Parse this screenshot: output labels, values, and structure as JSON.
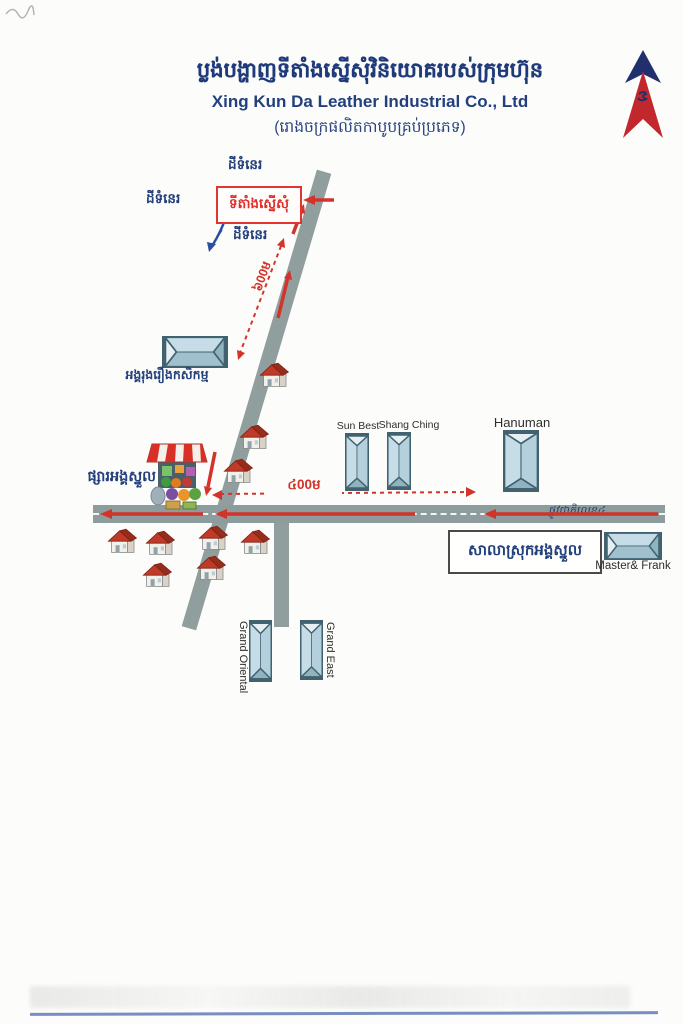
{
  "header": {
    "title_km": "ប្លង់បង្ហាញទីតាំងស្នើសុំវិនិយោគរបស់ក្រុមហ៊ុន",
    "title_en": "Xing Kun Da Leather Industrial Co., Ltd",
    "subtitle_km": "(រោងចក្រផលិតកាបូបគ្រប់ប្រភេទ)"
  },
  "map": {
    "site": {
      "label_km": "ទីតាំងស្នើសុំ"
    },
    "vacant_land": [
      "ដីទំនេរ",
      "ដីទំនេរ",
      "ដីទំនេរ"
    ],
    "distances": {
      "access_road": "៦00ម",
      "national_road": "៤00ម"
    },
    "roads": {
      "national_road_name": "ផ្លូវជាតិលេខ៤"
    },
    "landmarks": {
      "agriculture_company": "អង្គរុងរឿងកសិកម្ម",
      "market": "ផ្សារអង្គស្នួល",
      "district_hall": "សាលាស្រុកអង្គស្នួល",
      "sun_best": "Sun Best",
      "shang_ching": "Shang Ching",
      "hanuman": "Hanuman",
      "master_frank": "Master& Frank",
      "grand_oriental": "Grand Oriental",
      "grand_east": "Grand East"
    },
    "compass": "north-arrow",
    "colors": {
      "road_gray": "#8d9c9c",
      "accent_red": "#d2342c",
      "navy_text": "#1e3a7a",
      "building_fill": "#c7dde8"
    }
  }
}
